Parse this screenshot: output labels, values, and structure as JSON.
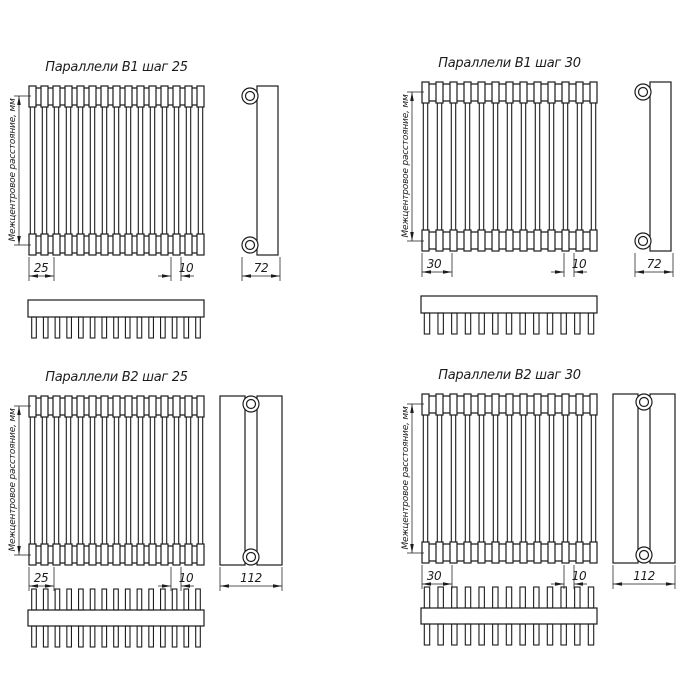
{
  "drawing": {
    "background": "#ffffff",
    "line_color": "#1c1c1c",
    "center_distance_label": "Межцентровое расстояние, мм",
    "quadrants": [
      {
        "id": "b1-step-25",
        "title": "Параллели В1 шаг 25",
        "step_dim": "25",
        "end_dim": "10",
        "side_dim": "72",
        "tubes": 15,
        "teeth": 15,
        "rows": 1
      },
      {
        "id": "b1-step-30",
        "title": "Параллели В1 шаг 30",
        "step_dim": "30",
        "end_dim": "10",
        "side_dim": "72",
        "tubes": 13,
        "teeth": 13,
        "rows": 1
      },
      {
        "id": "b2-step-25",
        "title": "Параллели В2 шаг 25",
        "step_dim": "25",
        "end_dim": "10",
        "side_dim": "112",
        "tubes": 15,
        "teeth": 15,
        "rows": 2
      },
      {
        "id": "b2-step-30",
        "title": "Параллели В2 шаг 30",
        "step_dim": "30",
        "end_dim": "10",
        "side_dim": "112",
        "tubes": 13,
        "teeth": 13,
        "rows": 2
      }
    ]
  }
}
